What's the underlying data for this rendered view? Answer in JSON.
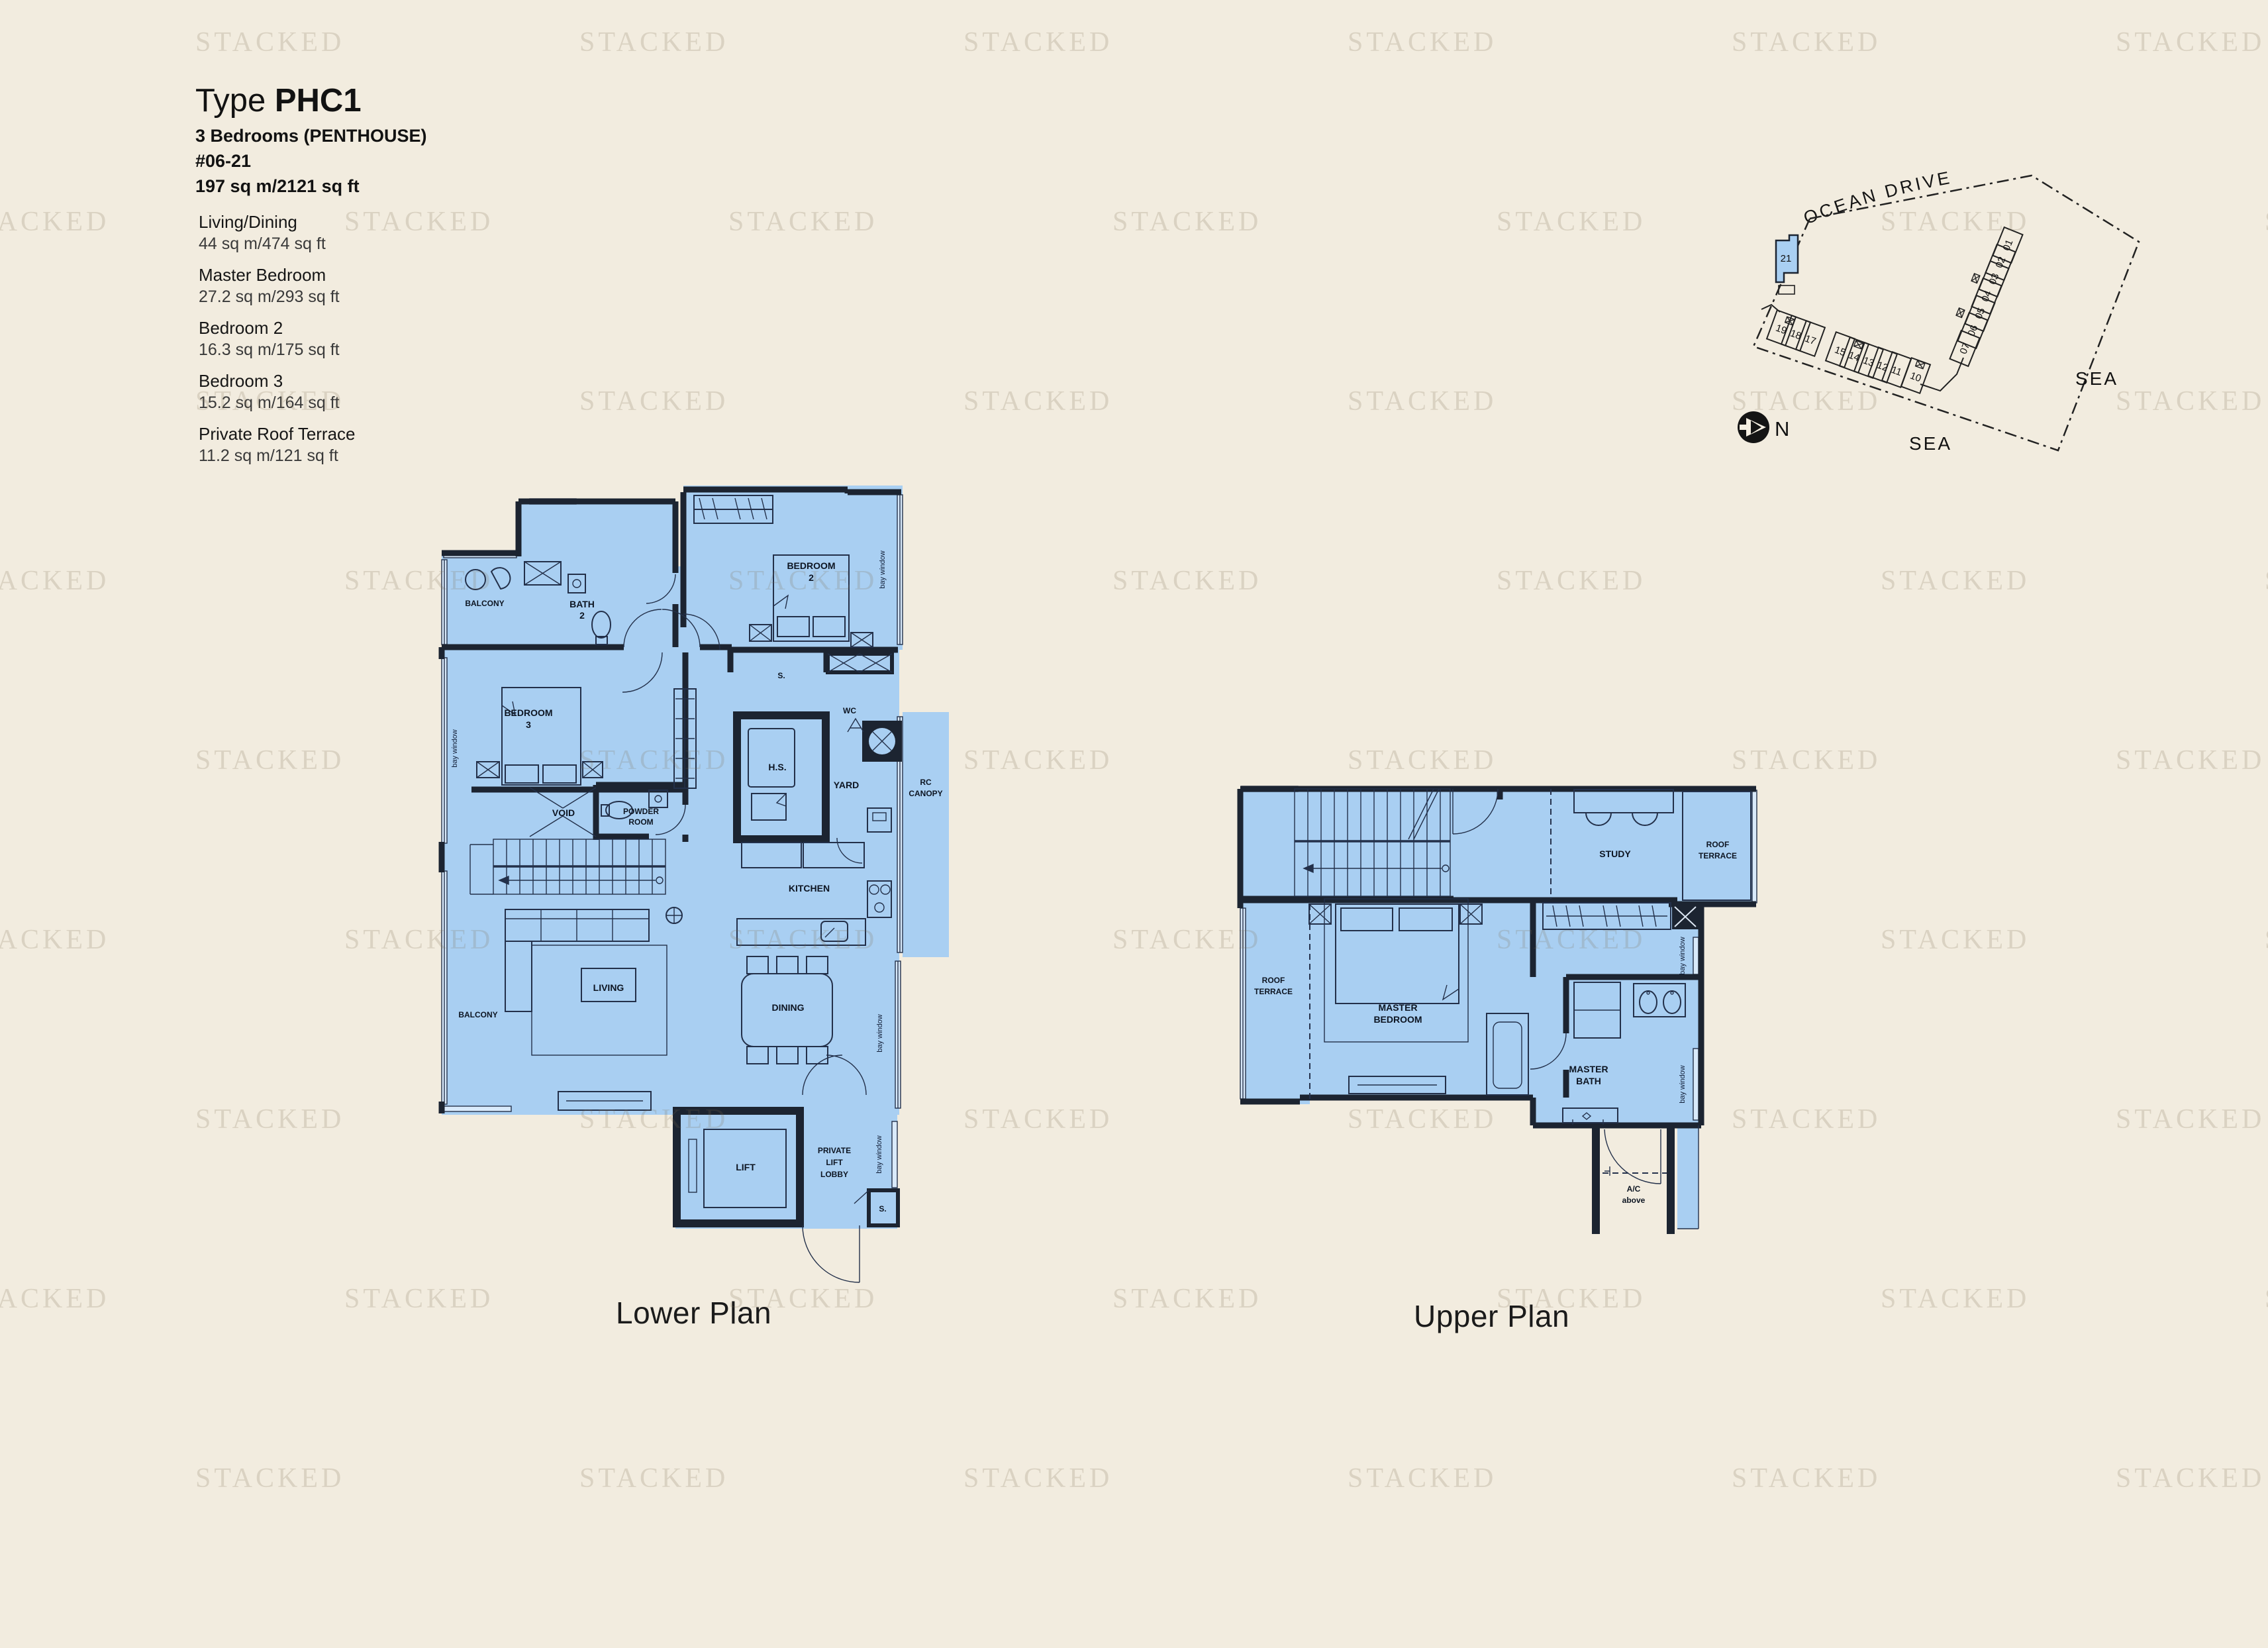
{
  "watermark": {
    "text": "STACKED"
  },
  "header": {
    "type_label": "Type",
    "type_code": "PHC1",
    "bedrooms": "3 Bedrooms (PENTHOUSE)",
    "unit_no": "#06-21",
    "total_area": "197 sq m/2121 sq ft"
  },
  "areas": [
    {
      "name": "Living/Dining",
      "area": "44 sq m/474 sq ft"
    },
    {
      "name": "Master Bedroom",
      "area": "27.2 sq m/293 sq ft"
    },
    {
      "name": "Bedroom 2",
      "area": "16.3 sq m/175 sq ft"
    },
    {
      "name": "Bedroom 3",
      "area": "15.2 sq m/164 sq ft"
    },
    {
      "name": "Private Roof Terrace",
      "area": "11.2 sq m/121 sq ft"
    }
  ],
  "site_plan": {
    "road": "OCEAN DRIVE",
    "sea_east": "SEA",
    "sea_south": "SEA",
    "north": "N",
    "highlight_unit": "21",
    "stacks_arc": [
      "19",
      "18",
      "17",
      "15",
      "14",
      "13",
      "12",
      "11",
      "10"
    ],
    "stacks_col": [
      "07",
      "06",
      "05",
      "04",
      "03",
      "02",
      "01"
    ]
  },
  "lower_plan": {
    "title": "Lower Plan",
    "labels": {
      "balcony": "BALCONY",
      "bath2": [
        "BATH",
        "2"
      ],
      "bedroom2": [
        "BEDROOM",
        "2"
      ],
      "bedroom3": [
        "BEDROOM",
        "3"
      ],
      "bay_window": "bay window",
      "store": "S.",
      "wc": "WC",
      "hs": "H.S.",
      "yard": "YARD",
      "rc_canopy": [
        "RC",
        "CANOPY"
      ],
      "void": "VOID",
      "powder_room": [
        "POWDER",
        "ROOM"
      ],
      "kitchen": "KITCHEN",
      "living": "LIVING",
      "dining": "DINING",
      "lift": "LIFT",
      "private_lift_lobby": [
        "PRIVATE",
        "LIFT",
        "LOBBY"
      ]
    }
  },
  "upper_plan": {
    "title": "Upper Plan",
    "labels": {
      "roof_terrace": [
        "ROOF",
        "TERRACE"
      ],
      "study": "STUDY",
      "master_bedroom": [
        "MASTER",
        "BEDROOM"
      ],
      "master_bath": [
        "MASTER",
        "BATH"
      ],
      "bay_window": "bay window",
      "ac_above": [
        "A/C",
        "above"
      ]
    }
  },
  "colors": {
    "background": "#f2ecdf",
    "floor_blue": "#a9cff2",
    "wall_dark": "#1c2431",
    "watermark": "rgba(124,110,80,0.20)"
  }
}
